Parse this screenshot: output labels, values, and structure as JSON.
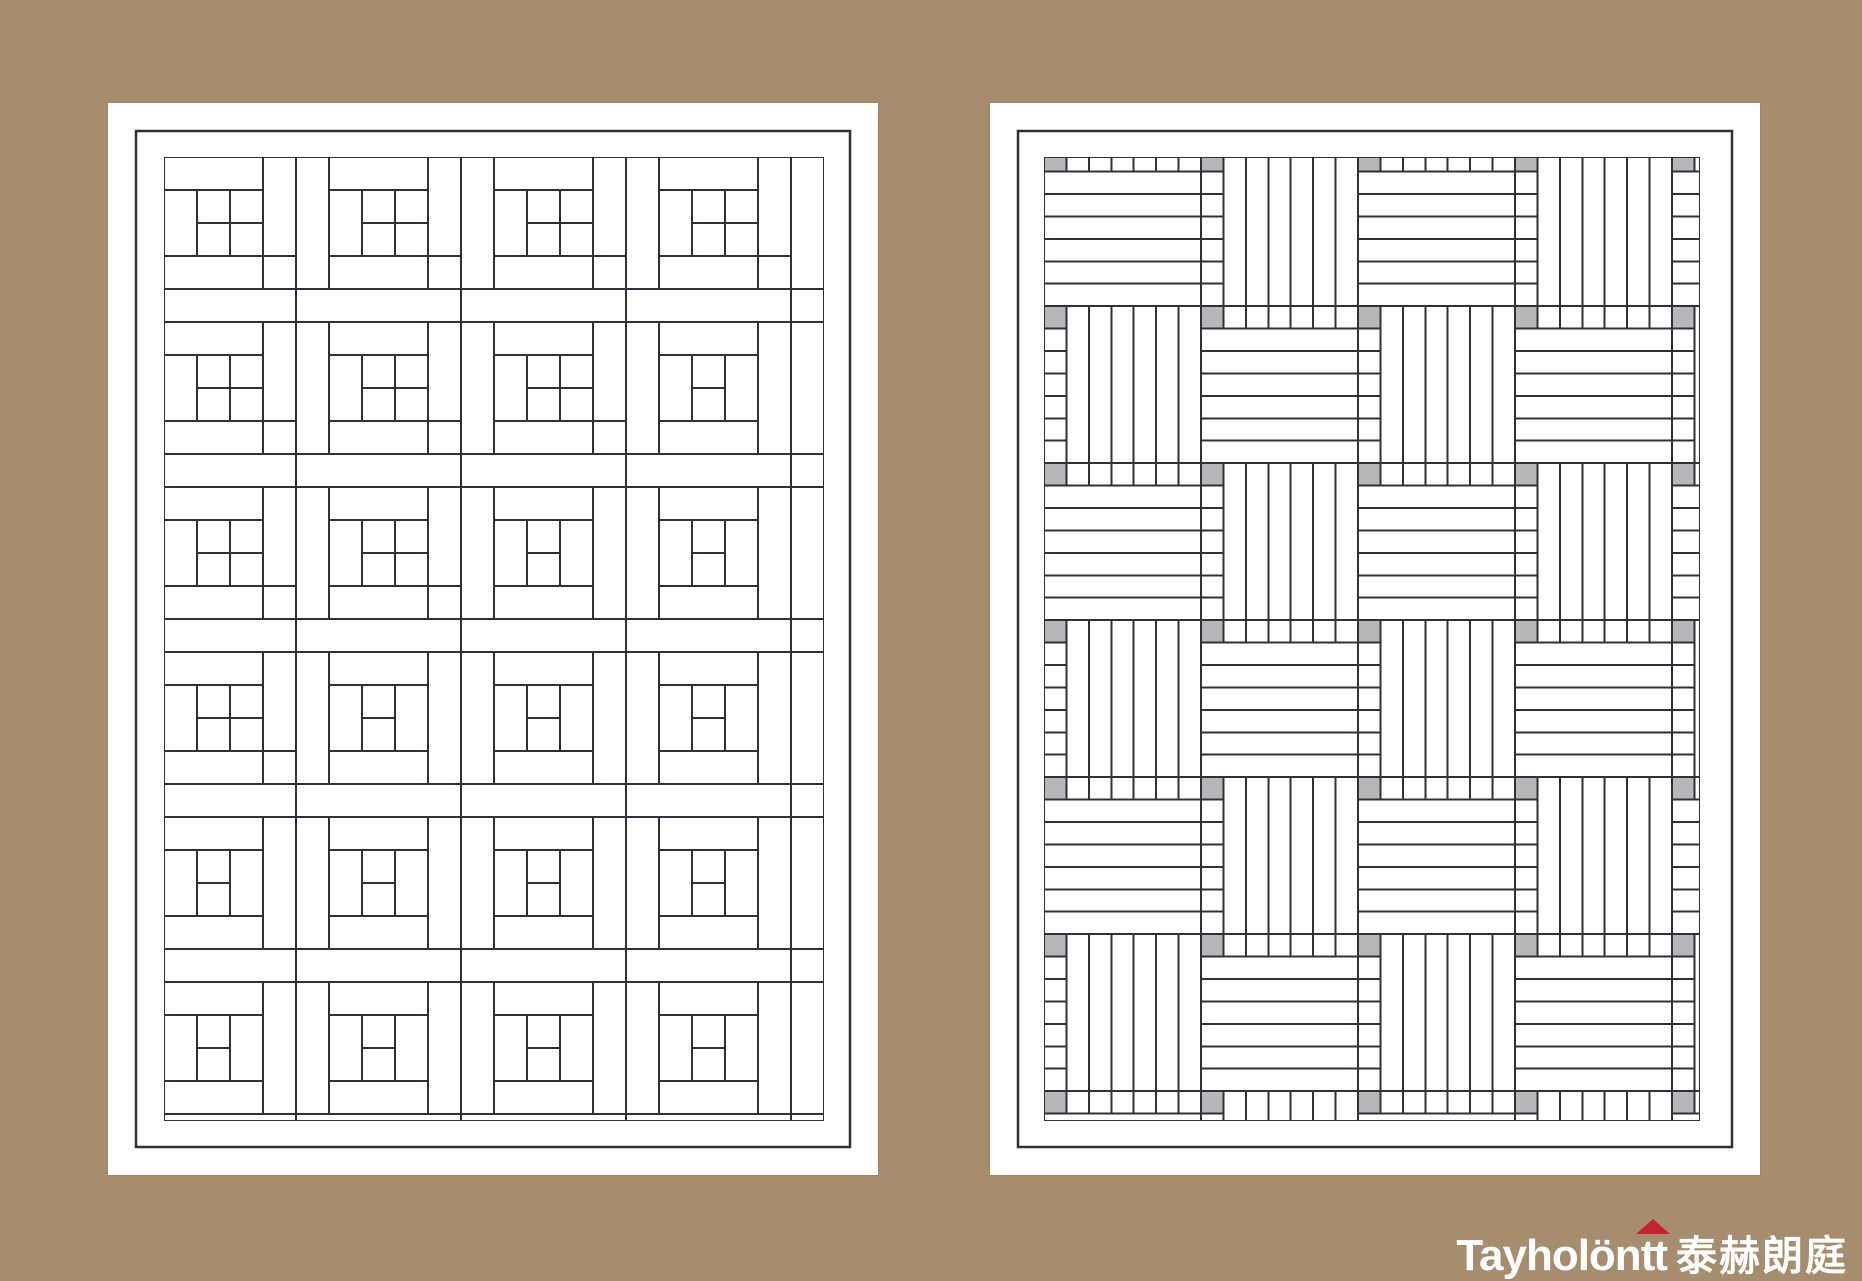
{
  "canvas": {
    "width": 1862,
    "height": 1281,
    "background_color": "#a68d6d"
  },
  "logo": {
    "text_latin": "Tayholön",
    "text_tt": "tt",
    "text_cjk": "泰赫朗庭",
    "text_color": "#ffffff",
    "roof_color": "#c5242c",
    "right": 14,
    "top": 1222
  },
  "left_panel": {
    "label": "staircase-parquet-diagram",
    "page": {
      "x": 108,
      "y": 103,
      "w": 770,
      "h": 1072,
      "color": "#ffffff"
    },
    "border_inset": 28,
    "border_stroke": 2.5,
    "field": {
      "x": 56,
      "y": 54,
      "w": 660,
      "h": 964
    },
    "unit": 33,
    "cols": 20,
    "rows": 30,
    "plank_len_units": 5,
    "phase": {
      "a0": 23,
      "b0": 5
    },
    "line_color": "#30303a",
    "line_width": 2,
    "plank_fill": "#ffffff"
  },
  "right_panel": {
    "label": "basketweave-parquet-diagram",
    "page": {
      "x": 990,
      "y": 103,
      "w": 770,
      "h": 1072,
      "color": "#ffffff"
    },
    "border_inset": 28,
    "border_stroke": 2.5,
    "field": {
      "x": 54,
      "y": 54,
      "w": 656,
      "h": 964
    },
    "unit": 22.4286,
    "tile_units": 7,
    "tile_cols": 5,
    "tile_rows": 7,
    "offset_y": -7.85,
    "planks_per_tile": 6,
    "key_color": "#b5b7b9",
    "line_color": "#30303a",
    "line_width": 2,
    "plank_fill": "#ffffff"
  }
}
